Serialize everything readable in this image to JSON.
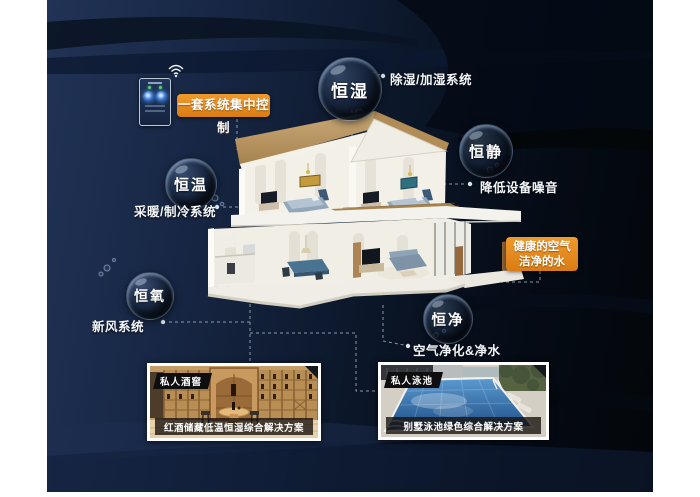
{
  "colors": {
    "accent_orange": "#e0861f",
    "background_navy": "#213356",
    "background_dark": "#04080c",
    "connector_line": "#a9bacb",
    "bubble_text": "#ffffff",
    "roof_tan": "#bb9a6a",
    "pool_blue": "#2e6cab",
    "wine_wood": "#c59e67"
  },
  "control_panel": {
    "label": "一套系统集中控制",
    "icon": "wifi-icon"
  },
  "bubbles": [
    {
      "label": "恒湿",
      "sublabel": "除湿/加湿系统"
    },
    {
      "label": "恒静",
      "sublabel": "降低设备噪音"
    },
    {
      "label": "恒温",
      "sublabel": "采暖/制冷系统"
    },
    {
      "label": "恒氧",
      "sublabel": "新风系统"
    },
    {
      "label": "恒净",
      "sublabel": "空气净化&净水"
    }
  ],
  "highlight_box": {
    "line1": "健康的空气",
    "line2": "洁净的水"
  },
  "photos": [
    {
      "tag": "私人酒窖",
      "caption": "红酒储藏低温恒湿综合解决方案"
    },
    {
      "tag": "私人泳池",
      "caption": "别墅泳池绿色综合解决方案"
    }
  ]
}
